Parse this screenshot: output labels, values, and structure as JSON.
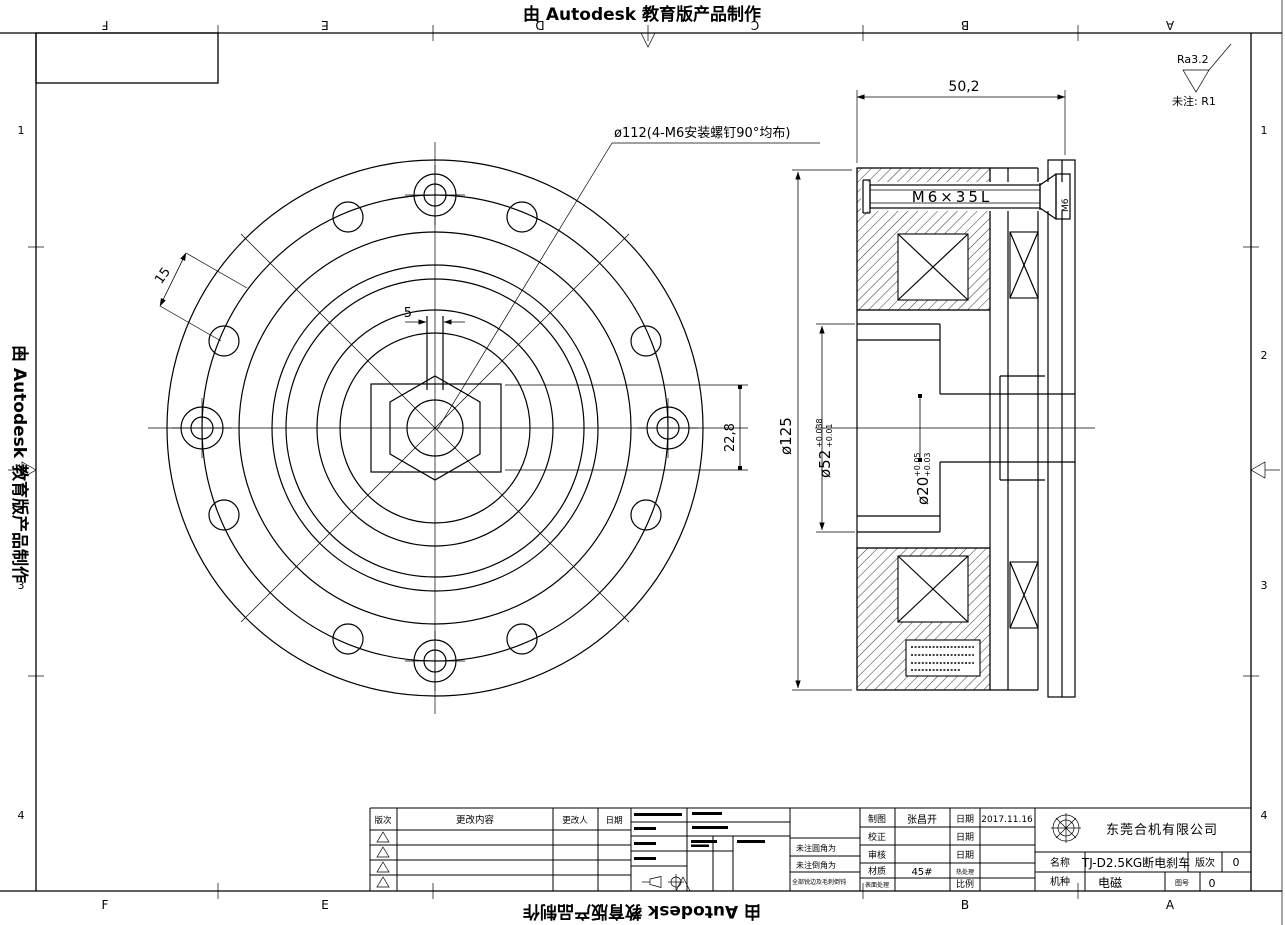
{
  "watermark": {
    "top": "由 Autodesk 教育版产品制作",
    "bottom": "由 Autodesk 教育版产品制作",
    "left": "由 Autodesk 教育版产品制作"
  },
  "frame": {
    "zones_h": [
      "F",
      "E",
      "D",
      "C",
      "B",
      "A"
    ],
    "zones_v": [
      "1",
      "2",
      "3",
      "4"
    ]
  },
  "finish_note": {
    "ra": "Ra3.2",
    "default_radius": "未注: R1"
  },
  "front_view": {
    "bolt_circle_callout": "ø112(4-M6安装螺钉90°均布)",
    "keyway_width": "5",
    "chamfer": "15",
    "hub_height": "22,8"
  },
  "section_view": {
    "overall_width": "50,2",
    "outer_dia": "ø125",
    "bore_dia": "ø52",
    "bore_tol_up": "+0.038",
    "bore_tol_low": "+0.01",
    "shaft_dia": "ø20",
    "shaft_tol_up": "+0.05",
    "shaft_tol_low": "+0.03",
    "screw": "M6×35L",
    "screw_thread": "M6"
  },
  "title_block": {
    "revision_headers": [
      "版次",
      "更改内容",
      "更改人",
      "日期"
    ],
    "notes": [
      "未注圆角为",
      "未注倒角为",
      "全部锐边及毛刺倒钝"
    ],
    "draw_label": "制图",
    "draw_value": "张昌开",
    "date_label": "日期",
    "date_value": "2017.11.16",
    "check_label": "校正",
    "audit_label": "审核",
    "material_label": "材质",
    "material_value": "45#",
    "heat_label": "热处理",
    "surface_label": "表面处理",
    "scale_label": "比例",
    "company": "东莞合机有限公司",
    "name_label": "名称",
    "name_value": "TJ-D2.5KG断电刹车",
    "rev_label": "版次",
    "rev_value": "0",
    "type_label": "机种",
    "type_value": "电磁",
    "dwgno_label": "图号",
    "dwgno_value": "0"
  }
}
